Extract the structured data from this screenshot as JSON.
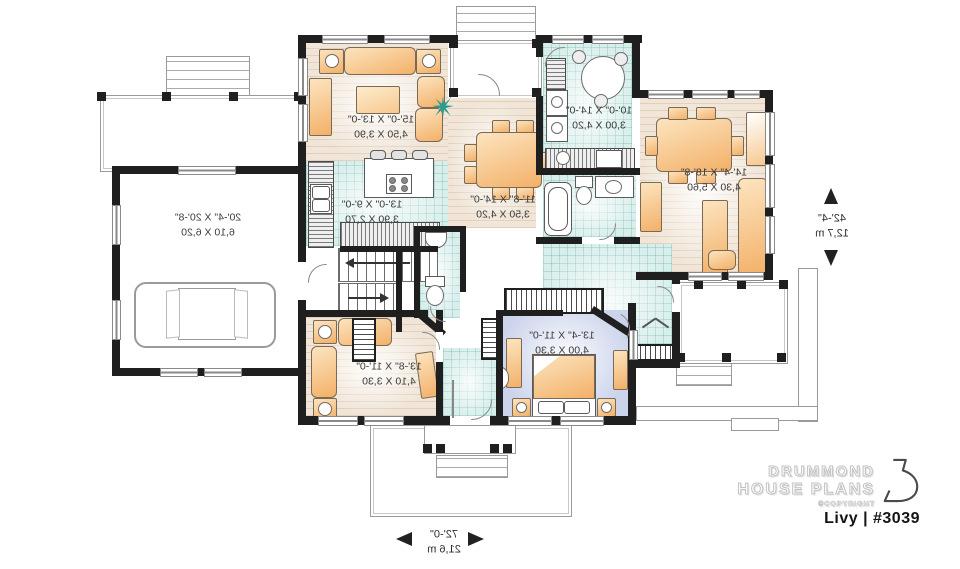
{
  "branding": {
    "brand_line1": "DRUMMOND",
    "brand_line2": "HOUSE PLANS",
    "copyright": "©COPYRIGHT",
    "plan_name": "Livy | #3039"
  },
  "overall_dimensions": {
    "width_imperial": "72'-0\"",
    "width_metric": "21,6 m",
    "depth_imperial": "42'-4\"",
    "depth_metric": "12,7 m"
  },
  "rooms": {
    "garage": {
      "imperial": "20'-4\" X 20'-8\"",
      "metric": "6,10 X 6,20"
    },
    "living": {
      "imperial": "15'-0\" X 13'-0\"",
      "metric": "4,50 X 3,90"
    },
    "kitchen": {
      "imperial": "13'-0\" X 9'-0\"",
      "metric": "3,90 X 2,70"
    },
    "dining": {
      "imperial": "11'-8\" X 14'-0\"",
      "metric": "3,50 X 4,20"
    },
    "laundry": {
      "imperial": "10'-0\" X 14'-0\"",
      "metric": "3,00 X 4,20"
    },
    "family": {
      "imperial": "14'-4\" X 18'-8\"",
      "metric": "4,30 X 5,60"
    },
    "den": {
      "imperial": "13'-8\" X 11'-0\"",
      "metric": "4,10 X 3,30"
    },
    "bedroom": {
      "imperial": "13'-4\" X 11'-0\"",
      "metric": "4,00 X 3,30"
    }
  },
  "colors": {
    "wall": "#1f1f1f",
    "tile_floor": "#d9eeeb",
    "wood_floor": "#f0e5d7",
    "bedroom_floor": "#ccd4ec",
    "furniture": "#f3b068",
    "plant": "#2a9d8f"
  }
}
